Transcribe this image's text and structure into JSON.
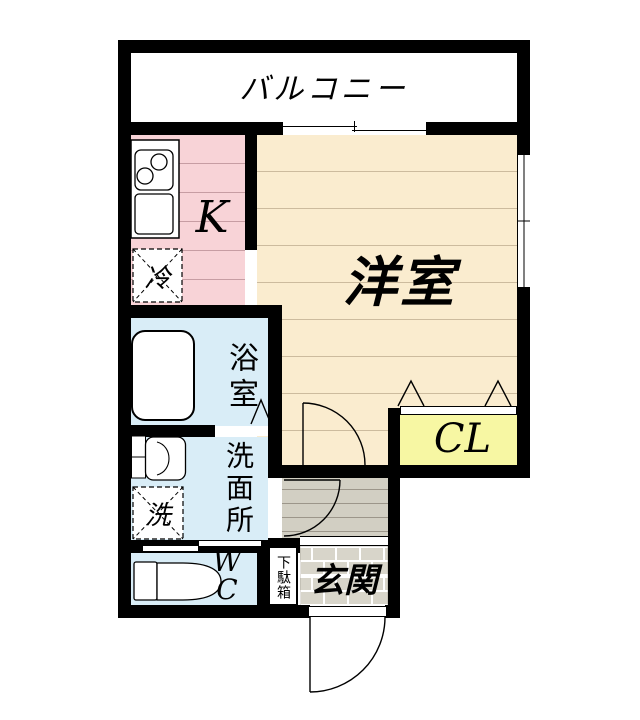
{
  "floorplan": {
    "rooms": {
      "balcony": {
        "label": "バルコニー"
      },
      "kitchen": {
        "label": "K"
      },
      "western_room": {
        "label": "洋室"
      },
      "bathroom": {
        "label": "浴室"
      },
      "washroom": {
        "label": "洗面所"
      },
      "toilet": {
        "label": "WC"
      },
      "closet": {
        "label": "CL"
      },
      "entrance": {
        "label": "玄関"
      }
    },
    "fixtures": {
      "refrigerator": {
        "label": "冷"
      },
      "washing_machine": {
        "label": "洗"
      },
      "shoe_cabinet": {
        "label": "下駄箱"
      }
    },
    "colors": {
      "wall": "#000000",
      "kitchen_floor": "#f8d3d7",
      "western_room_floor": "#faeccf",
      "wet_area_floor": "#d9edf7",
      "closet_fill": "#f7f7a3",
      "hallway_floor": "#d2cfc3",
      "entrance_tile": "#d8d5ca"
    }
  }
}
